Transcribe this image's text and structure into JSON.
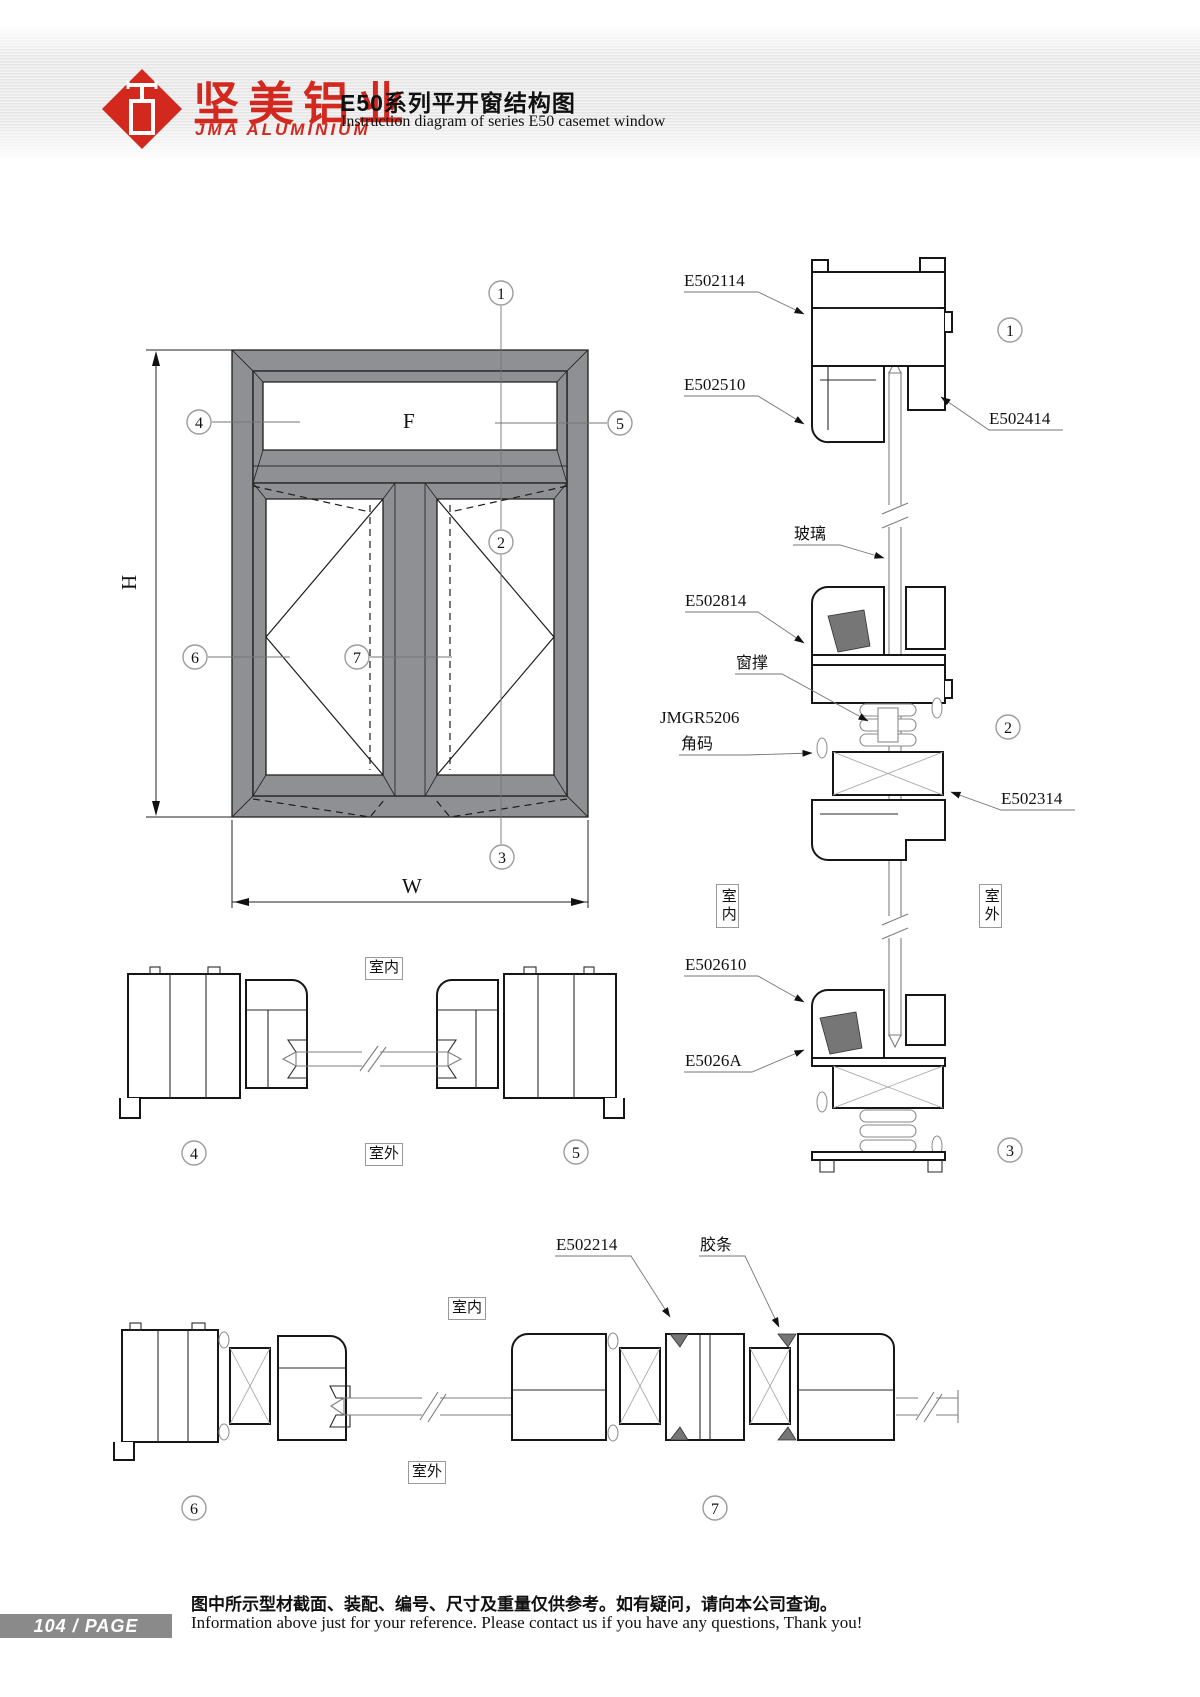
{
  "header": {
    "brand_cn": "坚美铝业",
    "brand_en": "JMA  ALUMINIUM",
    "title_cn": "E50系列平开窗结构图",
    "title_en": "Instruction diagram of series E50 casemet window"
  },
  "elevation": {
    "fixed_pane": "F",
    "height_dim": "H",
    "width_dim": "W"
  },
  "callouts": [
    "1",
    "2",
    "3",
    "4",
    "5",
    "6",
    "7"
  ],
  "labels": {
    "indoor": "室内",
    "outdoor": "室外",
    "glass": "玻璃",
    "window_stay": "窗撑",
    "corner_code_model": "JMGR5206",
    "corner_code": "角码",
    "gasket": "胶条"
  },
  "parts": {
    "e502114": "E502114",
    "e502510": "E502510",
    "e502414": "E502414",
    "e502814": "E502814",
    "e502314": "E502314",
    "e502610": "E502610",
    "e5026a": "E5026A",
    "e502214": "E502214"
  },
  "footer": {
    "page_number": "104",
    "page_sep": "/",
    "page_label": "PAGE",
    "note_cn": "图中所示型材截面、装配、编号、尺寸及重量仅供参考。如有疑问，请向本公司查询。",
    "note_en": "Information above just for your reference. Please contact us if you have any questions, Thank you!"
  },
  "colors": {
    "brand_red": "#d2281e",
    "frame_gray": "#8f9093",
    "outline_black": "#161616",
    "leader_gray": "#767676",
    "page_bar_gray": "#8a8a8a"
  }
}
